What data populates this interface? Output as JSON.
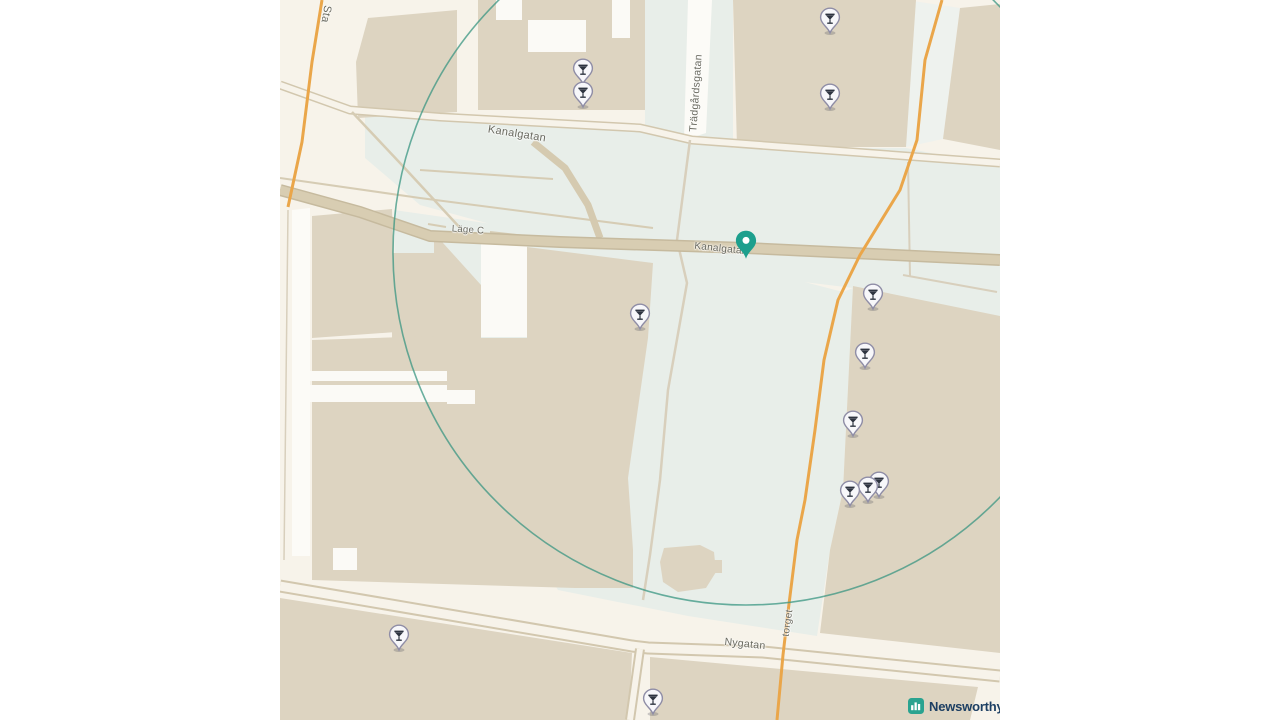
{
  "map": {
    "colors": {
      "margin": "#ffffff",
      "canvas": "#f7f3ea",
      "building": "#ddd4c1",
      "pedestrian_area": "#e8eee9",
      "courtyard_white": "#fbfaf6",
      "road_fill": "#d8cdb2",
      "road_casing": "#c6ba9e",
      "minor_road": "#d6ccb4",
      "orange_road": "#eaa64a",
      "white_road": "#fcfbf7",
      "geofence": "#3a9682",
      "label_text": "#69695f",
      "marker_fill": "#f7f7fa",
      "marker_stroke": "#8f8da6",
      "marker_glyph": "#2e3440",
      "pin_color": "#1d9f8d"
    },
    "street_labels": [
      {
        "name": "stationsgatan-partial",
        "text": "Sta",
        "x": 326,
        "y": 14,
        "rotation": 100,
        "size": 11
      },
      {
        "name": "kanalgatan-upper",
        "text": "Kanalgatan",
        "x": 517,
        "y": 134,
        "rotation": 9,
        "size": 11
      },
      {
        "name": "kanalgatan-lower",
        "text": "Kanalgatan",
        "x": 721,
        "y": 249,
        "rotation": 6,
        "size": 10
      },
      {
        "name": "tradgardsgatan",
        "text": "Trädgårdsgatan",
        "x": 696,
        "y": 93,
        "rotation": -86,
        "size": 10.5
      },
      {
        "name": "lage-c",
        "text": "Läge C",
        "x": 468,
        "y": 230,
        "rotation": 4,
        "size": 9.5
      },
      {
        "name": "nygatan",
        "text": "Nygatan",
        "x": 745,
        "y": 644,
        "rotation": 6,
        "size": 10.5
      },
      {
        "name": "torget",
        "text": "torget",
        "x": 788,
        "y": 623,
        "rotation": -82,
        "size": 10
      }
    ],
    "venue_markers": {
      "icon": "cocktail-glass",
      "points": [
        {
          "x": 583,
          "y": 68
        },
        {
          "x": 583,
          "y": 91
        },
        {
          "x": 830,
          "y": 17
        },
        {
          "x": 830,
          "y": 93
        },
        {
          "x": 640,
          "y": 313
        },
        {
          "x": 873,
          "y": 293
        },
        {
          "x": 865,
          "y": 352
        },
        {
          "x": 853,
          "y": 420
        },
        {
          "x": 879,
          "y": 481
        },
        {
          "x": 868,
          "y": 486
        },
        {
          "x": 850,
          "y": 490
        },
        {
          "x": 399,
          "y": 634
        },
        {
          "x": 653,
          "y": 698
        }
      ]
    },
    "selected_location_pin": {
      "x": 746,
      "y": 259,
      "color": "#1d9f8d"
    },
    "geofence_circle": {
      "cx": 746,
      "cy": 252,
      "r": 353
    },
    "attribution": {
      "brand": "Newsworthy",
      "text_color": "#1d3f63",
      "icon": "bar-chart",
      "icon_color": "#2aa390"
    }
  }
}
